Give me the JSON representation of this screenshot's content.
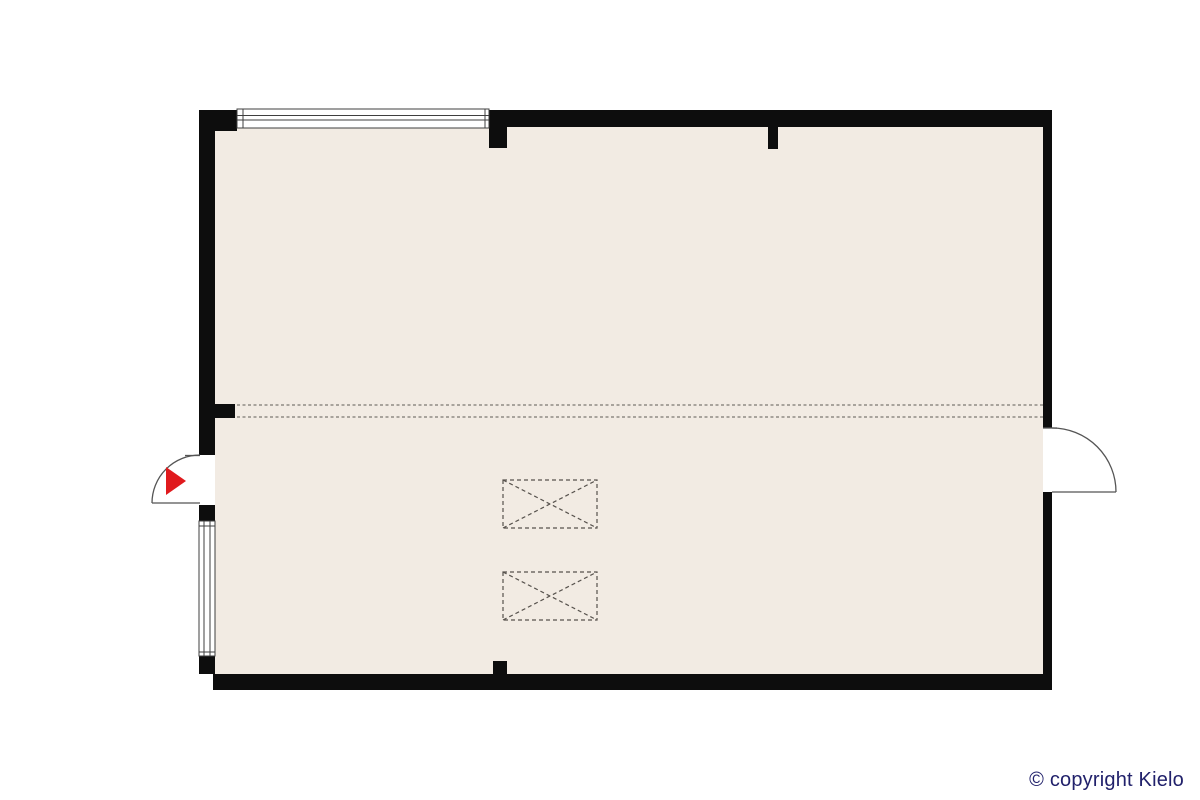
{
  "footer": {
    "copyright": "© copyright Kielo"
  },
  "colors": {
    "background": "#ffffff",
    "wall": "#0d0d0d",
    "floor": "#f2ebe3",
    "window_fill": "#ffffff",
    "window_stroke": "#3f3f3f",
    "door_stroke": "#555555",
    "dashed_line": "#8f8b85",
    "box_dash": "#57524d",
    "entrance_arrow": "#e01a1d",
    "copyright_text": "#21216b"
  },
  "floorplan": {
    "type": "architectural-floor-plan",
    "room_fill_label": "open floor area",
    "features": {
      "top_window": "long window in top wall",
      "left_window": "window in lower left wall",
      "left_entrance_door": "swing door with red entrance arrow pointing right",
      "right_door": "swing door opening outward on right wall",
      "level_change_line": "double dashed line across plan",
      "crossed_boxes": "two dashed rectangles with X (void/skylight symbols)"
    }
  }
}
